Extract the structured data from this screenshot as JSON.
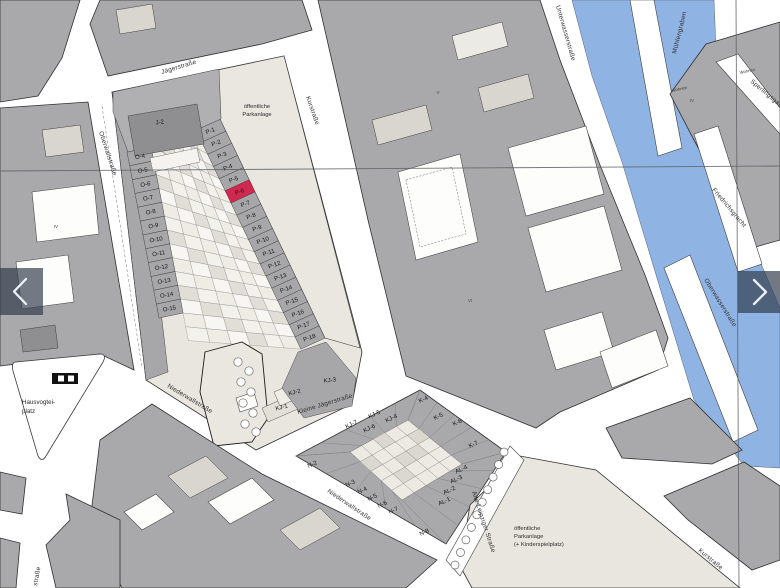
{
  "colors": {
    "highlight": "#d0294f",
    "water": "#8fb3e2",
    "block_gray": "#a9a9ab",
    "parcel_gray": "#a7a7a9",
    "beige": "#e9e6df",
    "overlay": "rgba(47,58,74,0.68)"
  },
  "streets": {
    "jaegerstrasse": "Jägerstraße",
    "oberwallstrasse": "Oberwallstraße",
    "kurstrasse": "Kurstraße",
    "niederwallstrasse": "Niederwallstraße",
    "kleine_jaegerstrasse": "Kleine Jägerstraße",
    "unterwasserstrasse": "Unterwasserstraße",
    "muehlengraben": "Mühlengraben",
    "friedrichsgracht": "Friedrichsgracht",
    "oberwasserstrasse": "Oberwasserstraße",
    "sperlingsgasse": "Sperlingsgasse",
    "alte_leipziger_strasse": "Alte Leipziger Straße",
    "partial_strasse": "straße"
  },
  "places": {
    "hausvogteiplatz_line1": "Hausvogtei-",
    "hausvogteiplatz_line2": "platz",
    "park_top_line1": "öffentliche",
    "park_top_line2": "Parkanlage",
    "park_bottom_line1": "öffentliche",
    "park_bottom_line2": "Parkanlage",
    "park_bottom_line3": "(+ Kinderspielplatz)"
  },
  "parcels": {
    "j": [
      "J-2"
    ],
    "o": [
      "O-4",
      "O-5",
      "O-6",
      "O-7",
      "O-8",
      "O-9",
      "O-10",
      "O-11",
      "O-12",
      "O-13",
      "O-14",
      "O-15"
    ],
    "p": [
      "P-1",
      "P-2",
      "P-3",
      "P-4",
      "P-5",
      "P-6",
      "P-7",
      "P-8",
      "P-9",
      "P-10",
      "P-11",
      "P-12",
      "P-13",
      "P-14",
      "P-15",
      "P-16",
      "P-17",
      "P-18"
    ],
    "highlighted": "P-6",
    "kj_lower": [
      "KJ-1",
      "KJ-2",
      "KJ-3"
    ],
    "kj_block": [
      "KJ-7",
      "KJ-6",
      "KJ-5",
      "KJ-4"
    ],
    "k": [
      "K-4",
      "K-5",
      "K-6",
      "K-7"
    ],
    "n": [
      "N-2",
      "N-3",
      "N-4",
      "N-5",
      "N-6",
      "N-7",
      "N-8"
    ],
    "al": [
      "AL-4",
      "AL-3",
      "AL-2",
      "AL-1"
    ]
  },
  "misc_labels": {
    "wohnen": "Wohnen",
    "roman": [
      "IV",
      "V",
      "VI",
      "IV"
    ]
  }
}
